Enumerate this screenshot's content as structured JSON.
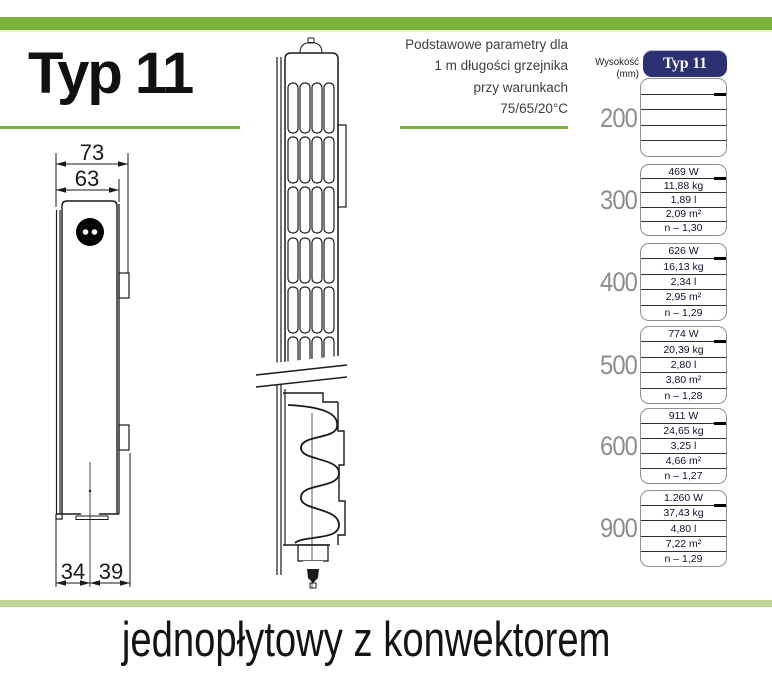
{
  "header": {
    "title": "Typ 11",
    "note_lines": [
      "Podstawowe parametry dla",
      "1 m długości grzejnika",
      "przy warunkach",
      "75/65/20°C"
    ]
  },
  "diagram": {
    "dim_top_outer": "73",
    "dim_top_inner": "63",
    "dim_bottom_left": "34",
    "dim_bottom_right": "39"
  },
  "table": {
    "height_header": "Wysokość (mm)",
    "type_header": "Typ 11",
    "rows": [
      {
        "height": "200",
        "values": [
          "",
          "",
          "",
          "",
          ""
        ]
      },
      {
        "height": "300",
        "values": [
          "469 W",
          "11,88 kg",
          "1,89 l",
          "2,09 m²",
          "n – 1,30"
        ]
      },
      {
        "height": "400",
        "values": [
          "626 W",
          "16,13 kg",
          "2,34 l",
          "2,95 m²",
          "n – 1,29"
        ]
      },
      {
        "height": "500",
        "values": [
          "774 W",
          "20,39 kg",
          "2,80 l",
          "3,80 m²",
          "n – 1,28"
        ]
      },
      {
        "height": "600",
        "values": [
          "911 W",
          "24,65 kg",
          "3,25 l",
          "4,66 m²",
          "n – 1,27"
        ]
      },
      {
        "height": "900",
        "values": [
          "1.260 W",
          "37,43 kg",
          "4,80 l",
          "7,22 m²",
          "n – 1,29"
        ]
      }
    ]
  },
  "footer": {
    "label": "jednopłytowy z konwektorem"
  },
  "colors": {
    "accent_green": "#7ab33c",
    "pale_green_band": "#bdd398",
    "navy_header": "#2b3173",
    "height_label_gray": "#8d8d8d"
  }
}
